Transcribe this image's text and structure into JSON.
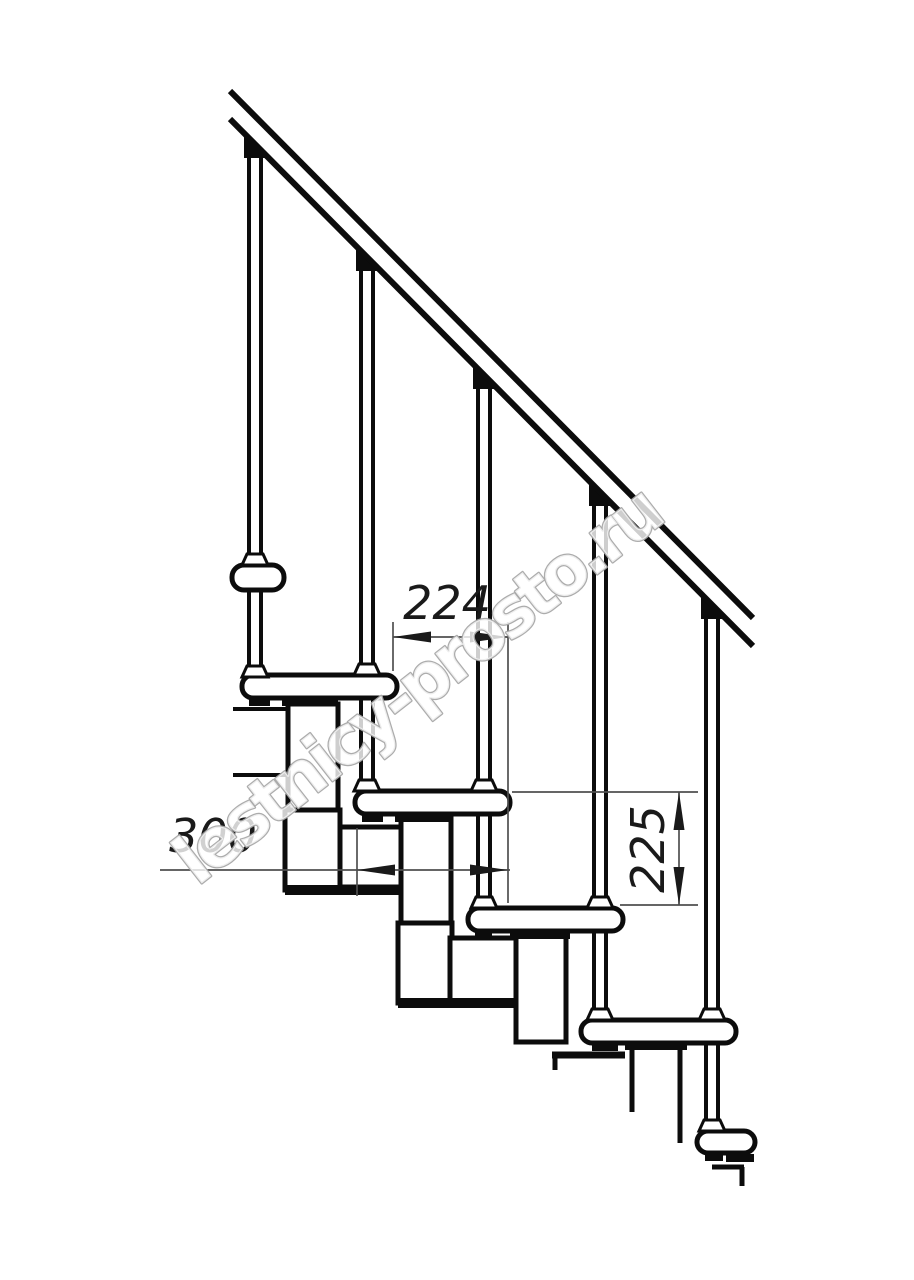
{
  "diagram": {
    "kind": "modular-staircase-side-view-technical-drawing",
    "background": "#ffffff",
    "line_color": "#0c0c0c",
    "dim_color": "#4f4f4f",
    "dimensions": {
      "going": {
        "value": "224",
        "orientation": "horizontal",
        "meaning": "horizontal offset between step noses"
      },
      "tread_depth": {
        "value": "300",
        "orientation": "horizontal",
        "meaning": "tread depth"
      },
      "rise": {
        "value": "225",
        "orientation": "vertical",
        "meaning": "step rise height"
      }
    },
    "watermark": {
      "text": "lestnicy-prosto.ru",
      "outline_color": "#a8a8a8"
    }
  }
}
